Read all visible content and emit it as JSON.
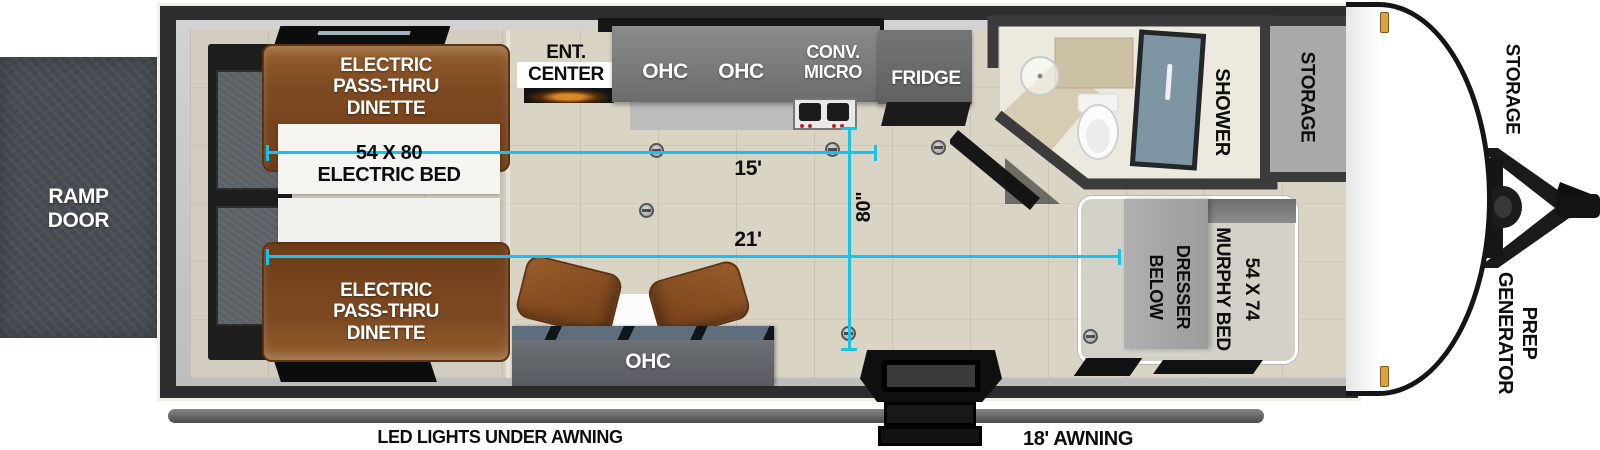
{
  "labels": {
    "ramp_door": "RAMP\nDOOR",
    "dinette_top": "ELECTRIC\nPASS-THRU\nDINETTE",
    "dinette_bottom": "ELECTRIC\nPASS-THRU\nDINETTE",
    "garage_bed": "54 X 80\nELECTRIC BED",
    "ent_center": "ENT.\nCENTER",
    "ohc_kitchen_left": "OHC",
    "ohc_kitchen_right": "OHC",
    "conv_micro": "CONV.\nMICRO",
    "fridge": "FRIDGE",
    "shower": "SHOWER",
    "storage_front": "STORAGE",
    "storage_pass_thru": "STORAGE",
    "murphy_bed": "54 X 74\nMURPHY BED",
    "dresser": "DRESSER\nBELOW",
    "generator": "GENERATOR",
    "generator_prep": "PREP",
    "ohc_living": "OHC",
    "led_lights": "LED LIGHTS UNDER AWNING",
    "awning": "18' AWNING"
  },
  "measurements": {
    "garage_length": "15'",
    "main_length": "21'",
    "interior_width": "80\""
  },
  "colors": {
    "dimension_line": "#17c3e8",
    "ramp_door": "#484d53",
    "dinette_brown": "#7d4a22",
    "floor": "#dad4c5",
    "frame_black": "#2d2d2d",
    "marker_light": "#e0a13f"
  }
}
